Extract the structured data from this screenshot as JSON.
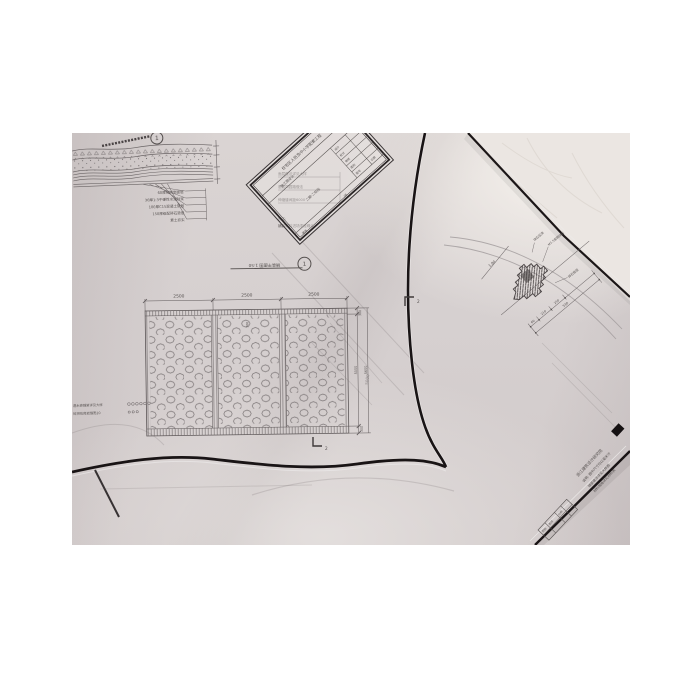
{
  "photo": {
    "alt": "Overhead photograph of overlapping architectural construction drawings on translucent tracing paper",
    "colors": {
      "paper": "#d5cfcf",
      "paper_light": "#ece7e3",
      "ink": "#55504f",
      "frame": "#1a1516"
    }
  },
  "section_detail": {
    "marker": "1",
    "layers": [
      "60厚花岗岩面层",
      "30厚1:3干硬性水泥砂浆",
      "100厚C15混凝土垫层",
      "150厚级配碎石垫层",
      "素土夯实"
    ],
    "side_notes": [
      "面层做法详见大样",
      "基层同园路做法",
      "伸缩缝间距6000"
    ],
    "note_title": "附注:",
    "note_text": "铺装材料进场须经确认"
  },
  "plan": {
    "title_label": "铺装平面图 1:50",
    "marker": "1",
    "dims_top": [
      "2500",
      "2500",
      "2500"
    ],
    "dim_right_a": "300",
    "dim_right_b": "5000",
    "dim_right_c": "300",
    "dim_total": "5600",
    "dim_small": "500",
    "section_mark": "2",
    "notes": [
      "透水砖铺装详见大样",
      "碎拼花岗岩缝宽20"
    ]
  },
  "under_sheet": {
    "dim": "5000"
  },
  "right_detail": {
    "dim_top": "1.80",
    "dims": [
      "60",
      "210",
      "250"
    ],
    "dim_total": "530",
    "labels": [
      "块石压顶",
      "M7.5浆砌块石",
      "碎石垫层"
    ]
  },
  "title_block": {
    "project": "住宅区人防及中小学配套工程",
    "stage": "施工图设计",
    "section": "二期·二标段",
    "cells": [
      "设计",
      "校对",
      "审核",
      "图别",
      "图号",
      "日期"
    ],
    "footer_left": "建施",
    "footer_right": "06"
  },
  "bottom_sheet": {
    "lines": [
      "浙江建筑设计研究院",
      "说明: 图中尺寸均以毫米计",
      "铺装做法详见大样图",
      "材料规格详见材料表"
    ],
    "cells": [
      "图别",
      "图号",
      "比例"
    ]
  }
}
